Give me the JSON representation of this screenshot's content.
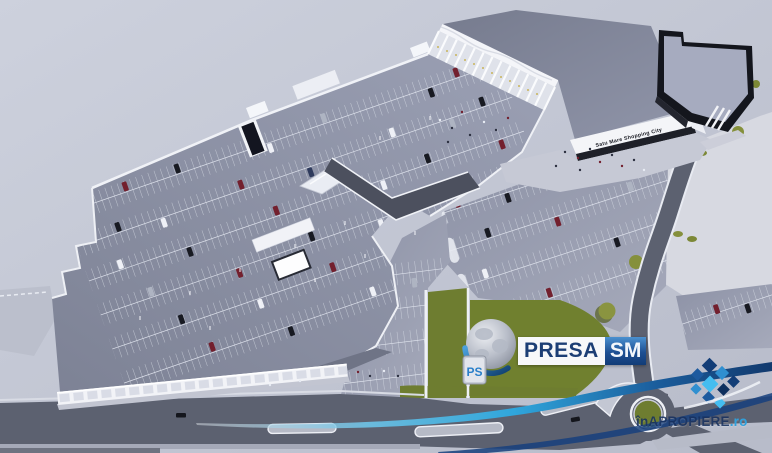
{
  "scene": {
    "type": "aerial-3d-architectural-rendering",
    "building_sign": "Satu Mare Shopping City"
  },
  "watermarks": {
    "presa": {
      "wordmark": "PRESA",
      "badge": "SM",
      "monogram": "PS"
    },
    "apropiere": {
      "wordmark": "înAPROPIERE",
      "tld": ".ro"
    }
  },
  "colors": {
    "background": "#c6cad8",
    "rooftop_deck": "#878ca0",
    "main_roof": "#82879b",
    "asphalt": "#9297ab",
    "road": "#5c6170",
    "sidewalk": "#eef0f5",
    "facade_white": "#f3f4f8",
    "dark_store": "#14161d",
    "grass": "#6e7d30",
    "tree": "#8a9440",
    "presa_navy": "#1c3e75",
    "presa_blue": "#2d6cb0",
    "swoosh_cyan": "#2fa6dc",
    "apropiere_navy": "#14305f",
    "apropiere_cyan": "#2fa0dc"
  },
  "icons": {
    "presa_logo": "globe-icon",
    "apropiere_logo": "mosaic-diamonds-icon",
    "overlay": "swoosh-icon"
  }
}
